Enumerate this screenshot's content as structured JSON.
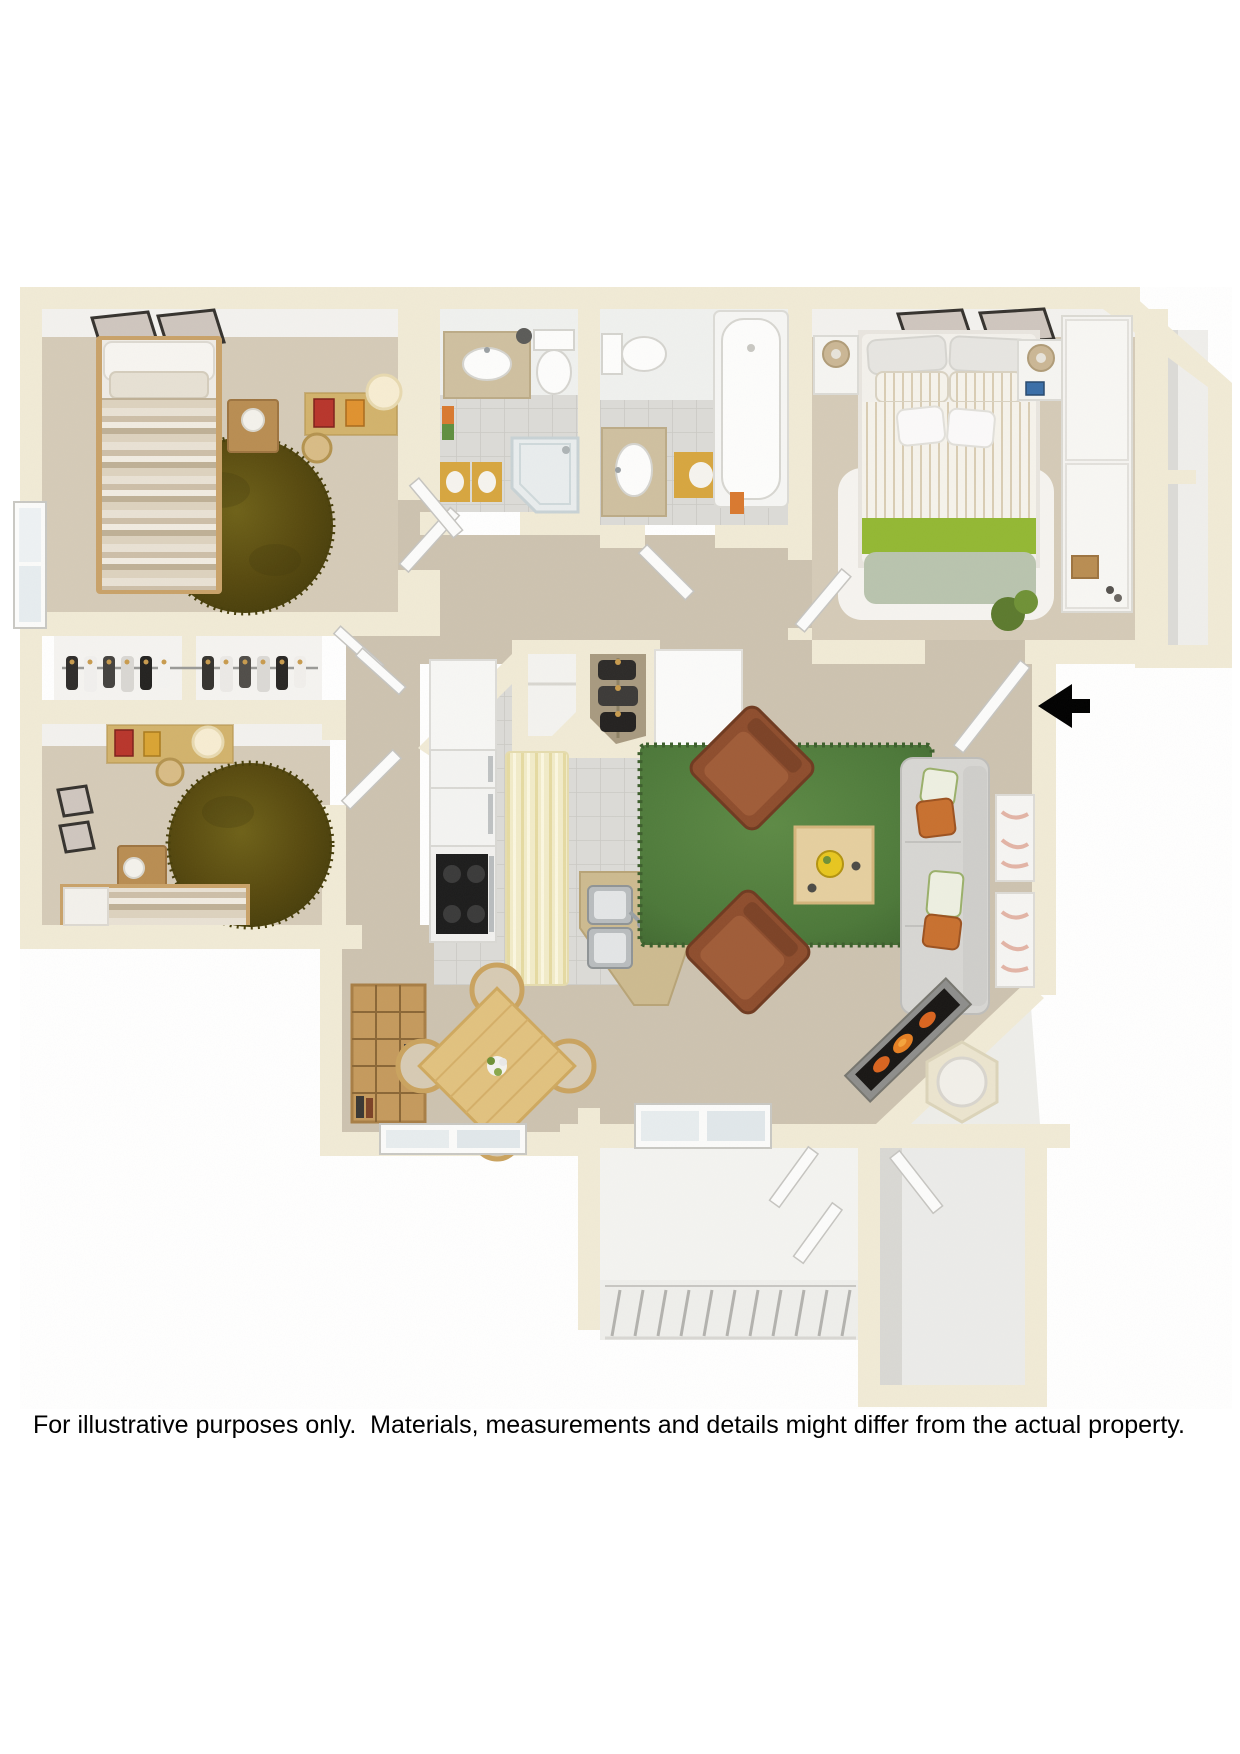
{
  "page": {
    "background_color": "#ffffff"
  },
  "caption": {
    "text": "For illustrative purposes only.  Materials, measurements and details might differ from the actual property.",
    "color": "#000000"
  },
  "floor_plan": {
    "type": "3d_top_down_apartment_floor_plan",
    "palette": {
      "wall": "#f1ebd6",
      "wall_face": "#f3f2ef",
      "carpet": "#d5cbb8",
      "carpet_hall": "#cdc3b0",
      "tile": "#dcdbd7",
      "tile_line": "#cbcac5",
      "rug_olive": "#5c530f",
      "rug_green": "#507b3b",
      "rug_white": "#f7f6f3",
      "wood": "#c9a269",
      "wood_light": "#e2c27f",
      "counter_tan": "#cdbb90",
      "chair_brown": "#8e4d2d",
      "sofa_gray": "#d7d6d3",
      "accent_green": "#8fb832",
      "accent_sage": "#b9c4ae",
      "steel": "#b9bdbf",
      "mat_gold": "#d7a63f",
      "fire_orange": "#d9641f",
      "arrow_black": "#000000",
      "patio_concrete": "#f3f3f0"
    },
    "rooms": [
      {
        "id": "bedroom-2",
        "name": "Bedroom 2",
        "furniture": [
          "twin bed with striped duvet",
          "round olive shag rug",
          "nightstand with lamp",
          "desk with stool and paper lamp",
          "two wall frames",
          "window"
        ]
      },
      {
        "id": "wardrobe-closet",
        "name": "Wardrobe closet",
        "furniture": [
          "hanging rod with clothes on hangers"
        ]
      },
      {
        "id": "bedroom-3",
        "name": "Bedroom 3",
        "furniture": [
          "twin bed with striped duvet",
          "round olive shag rug",
          "desk with stool",
          "nightstand with lamp",
          "wall frames"
        ]
      },
      {
        "id": "bathroom-1",
        "name": "Bathroom 1",
        "furniture": [
          "vanity with oval sink",
          "toilet",
          "corner glass shower",
          "gold bath mats",
          "towels"
        ]
      },
      {
        "id": "bathroom-2",
        "name": "Bathroom 2",
        "furniture": [
          "toilet",
          "vanity with oval sink",
          "bathtub",
          "gold bath mat"
        ]
      },
      {
        "id": "master-bedroom",
        "name": "Master Bedroom",
        "furniture": [
          "queen bed with green accent throw",
          "white shag rug",
          "two nightstands with lamps",
          "sliding-door closet with basket",
          "two wall frames",
          "plant"
        ]
      },
      {
        "id": "hallway",
        "name": "Hallway",
        "furniture": [
          "linen closet",
          "coat closet"
        ]
      },
      {
        "id": "kitchen",
        "name": "Kitchen",
        "furniture": [
          "refrigerator",
          "range with black cooktop",
          "striped runner rug",
          "L-shaped counter",
          "double stainless sink"
        ]
      },
      {
        "id": "living-room",
        "name": "Living Room",
        "furniture": [
          "green area rug",
          "two brown leather armchairs",
          "square coffee table with bowl",
          "gray sofa with orange and leaf pillows",
          "two wall art frames",
          "corner fireplace"
        ]
      },
      {
        "id": "dining-room",
        "name": "Dining Room",
        "furniture": [
          "square wood dining table with flowers",
          "four chairs",
          "cube bookshelf",
          "double window"
        ]
      },
      {
        "id": "utility-closet",
        "name": "Utility closet",
        "furniture": [
          "round water heater"
        ]
      },
      {
        "id": "patio",
        "name": "Patio",
        "furniture": [
          "sliding glass door",
          "staircase with railing"
        ]
      },
      {
        "id": "storage-room",
        "name": "Storage room",
        "furniture": [
          "door"
        ]
      },
      {
        "id": "exterior-chase",
        "name": "Exterior closet chase",
        "furniture": []
      }
    ],
    "entry": {
      "arrow_direction": "left",
      "arrow_color": "#000000"
    },
    "stairs": {
      "tread_count": 11
    }
  }
}
